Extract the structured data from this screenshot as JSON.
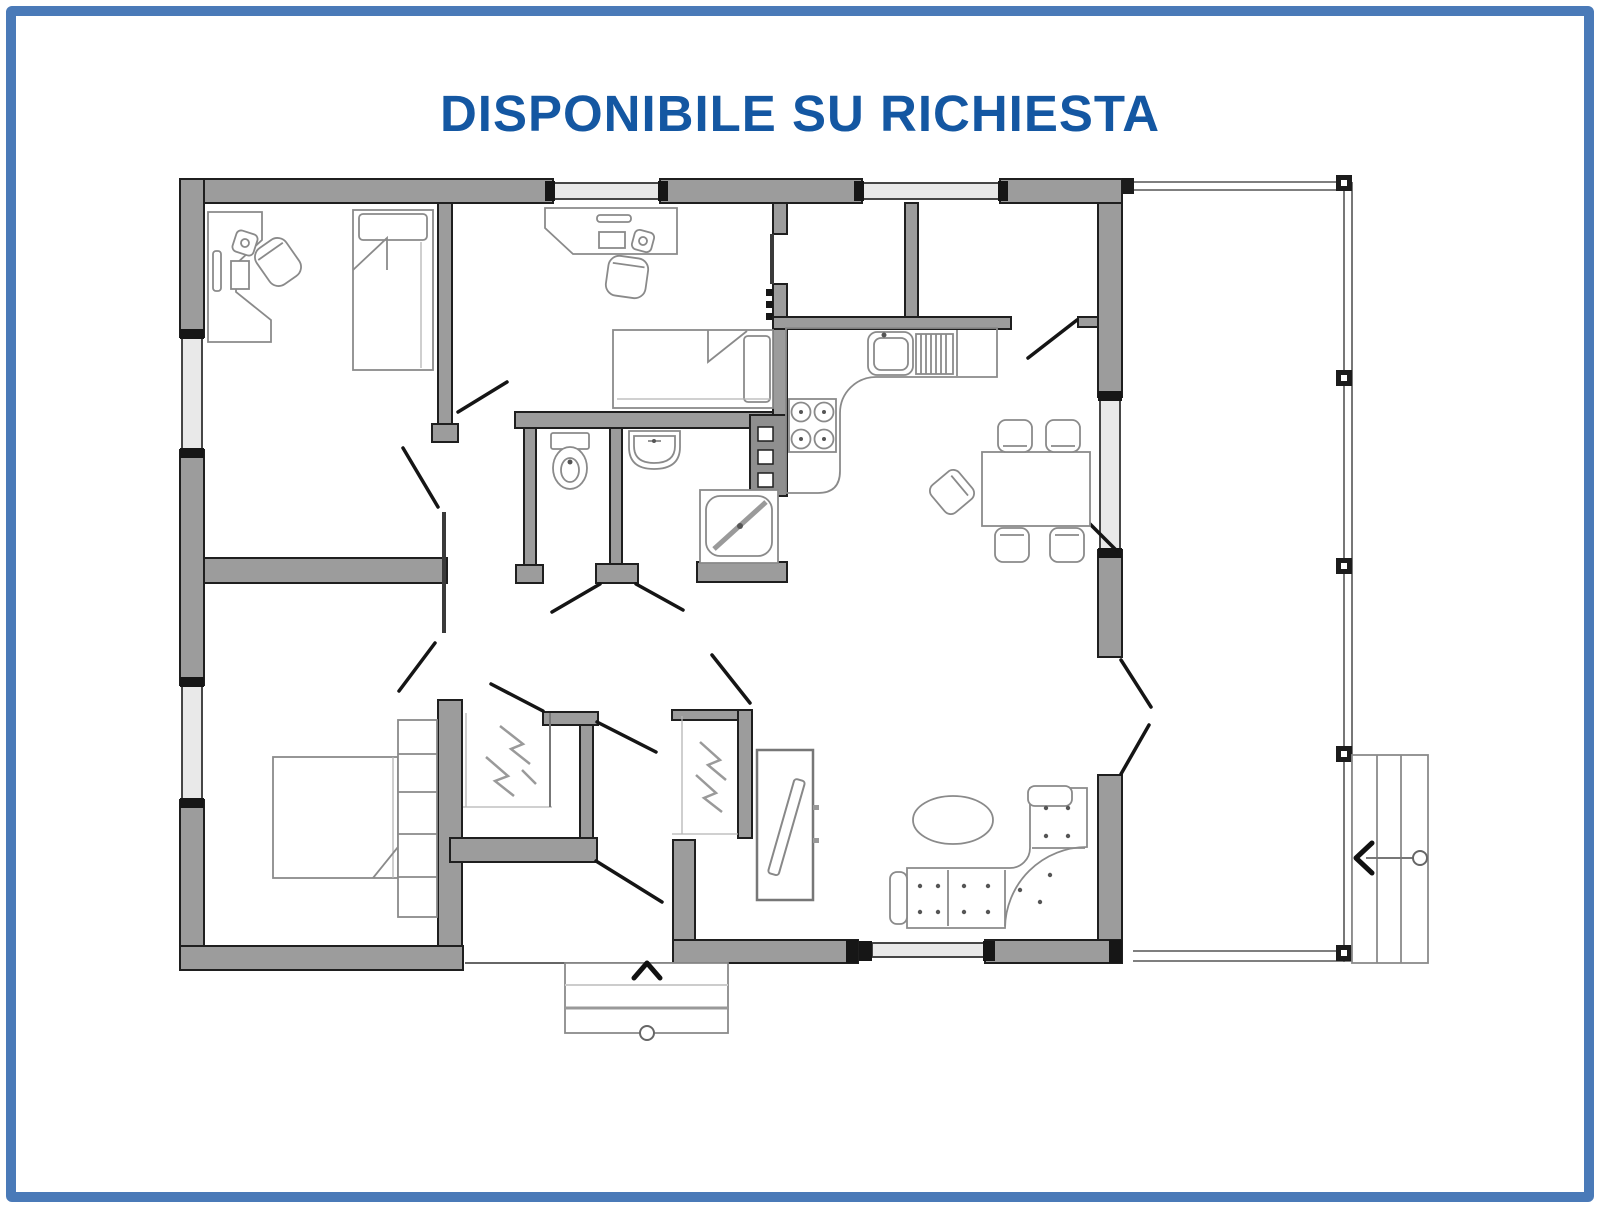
{
  "title": {
    "text": "DISPONIBILE SU RICHIESTA",
    "color": "#1457a2"
  },
  "frame": {
    "border_color": "#4a7ab8",
    "background": "#ffffff"
  },
  "plan": {
    "colors": {
      "wall_fill": "#9c9c9c",
      "wall_outline": "#1f1f1f",
      "window_fill": "#e9e9e9",
      "door_line": "#151515",
      "furniture_line": "#8a8a8a"
    },
    "symbols": [
      "entry-arrow-up",
      "stairs-arrow-left",
      "door-swing-lines",
      "window-double-lines"
    ],
    "rooms": {
      "bedroom_top_left": [
        "desk",
        "office-chair",
        "desk-lamp",
        "monitor",
        "keyboard",
        "single-bed"
      ],
      "bedroom_top_middle": [
        "desk",
        "office-chair",
        "desk-lamp",
        "keyboard",
        "single-bed"
      ],
      "pantry_top_right": [],
      "kitchen": [
        "l-shaped-counter",
        "sink",
        "dish-drainer",
        "stove-four-burners",
        "boiler-flue"
      ],
      "bathroom": [
        "toilet",
        "washbasin",
        "corner-shower"
      ],
      "master_bedroom": [
        "double-bed",
        "shelf-column",
        "walk-in-closet-hangers"
      ],
      "entrance": [
        "coat-closet-hangers",
        "front-door",
        "entry-steps"
      ],
      "living_dining": [
        "dining-table",
        "dining-chairs-5",
        "corner-sofa",
        "oval-coffee-table",
        "tv-cabinet"
      ],
      "exterior": [
        "porch",
        "porch-posts",
        "side-steps"
      ]
    }
  }
}
